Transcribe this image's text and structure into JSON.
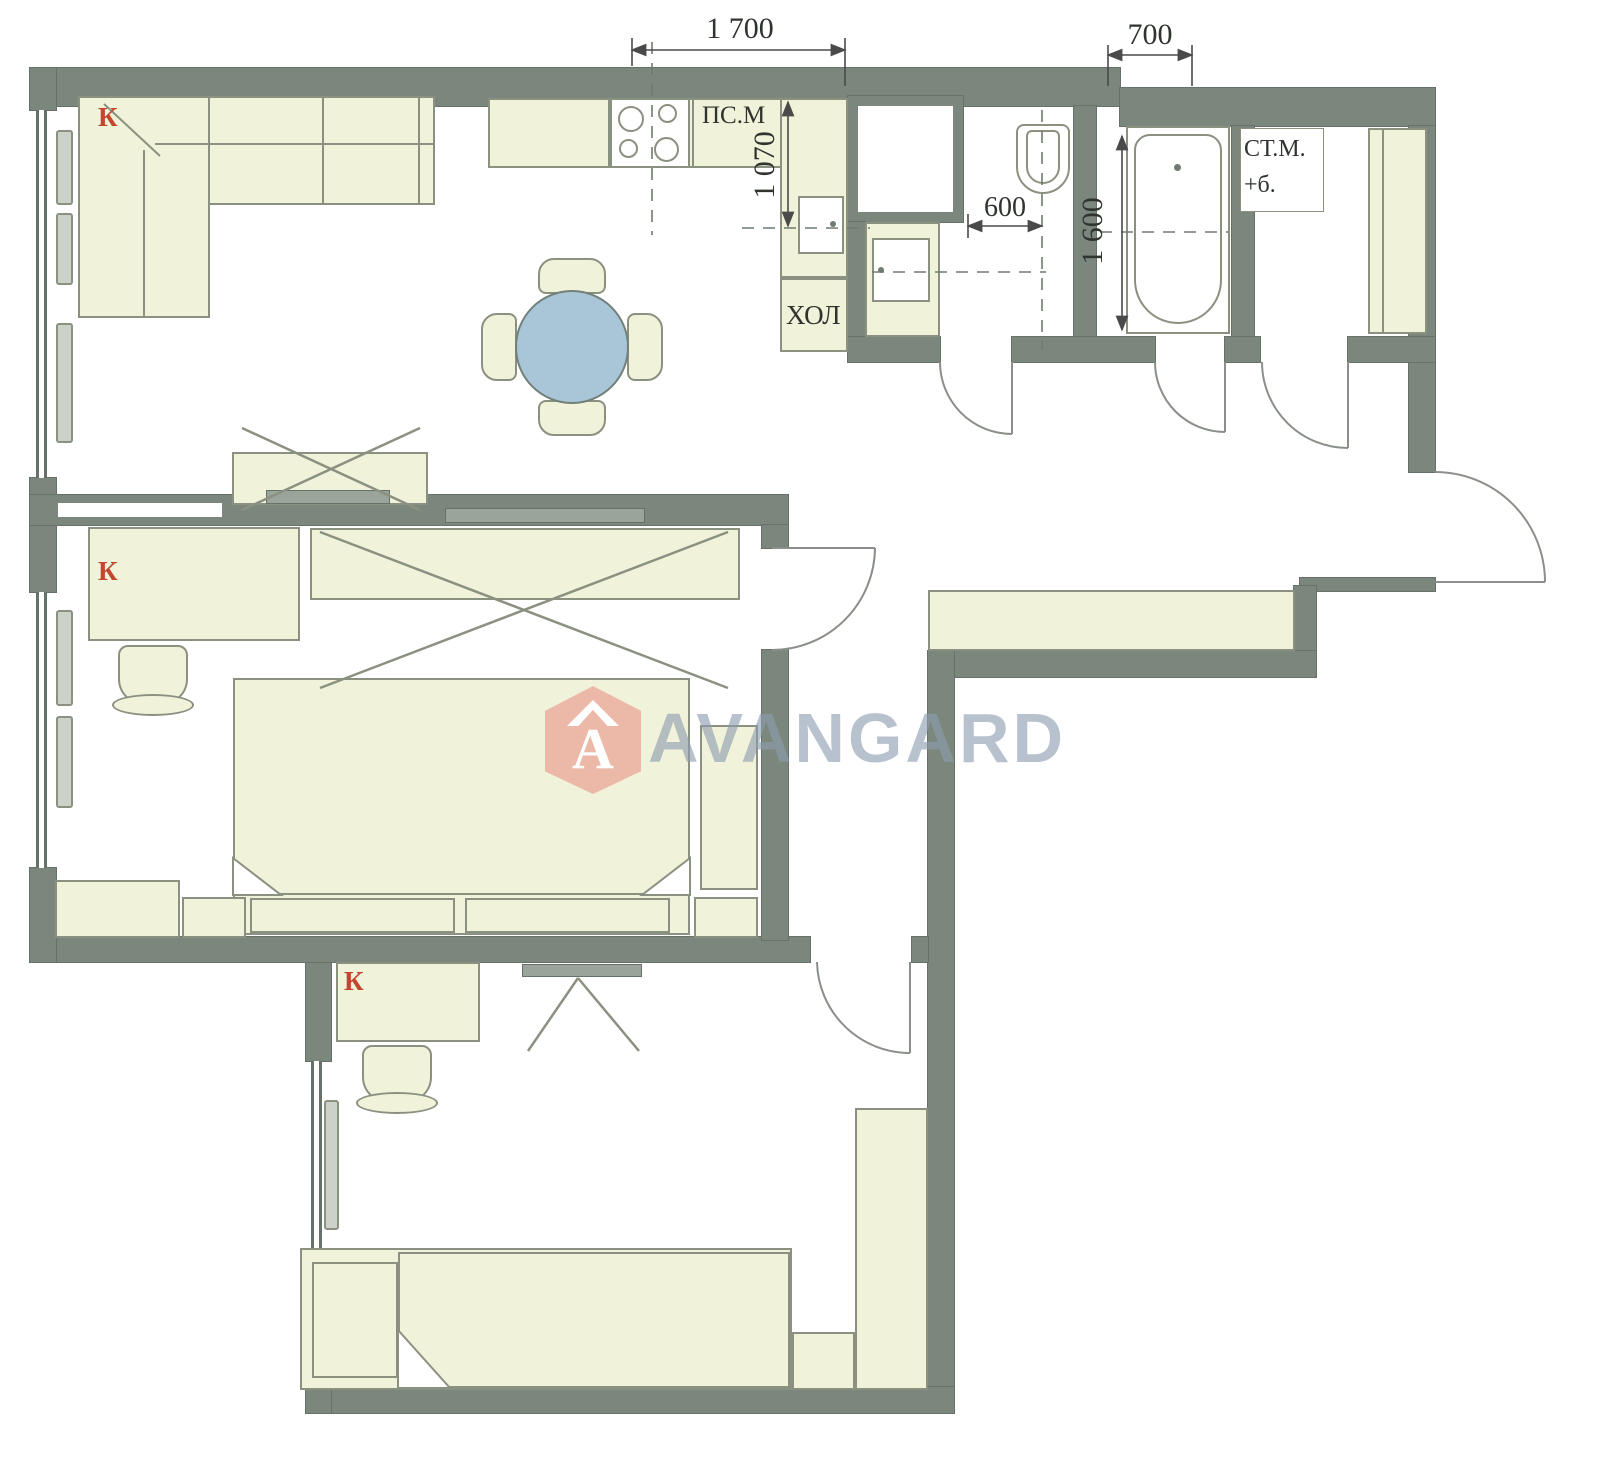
{
  "watermark": {
    "brand": "AVANGARD",
    "logo_letter": "A"
  },
  "dimensions": {
    "kitchen_top": "1 700",
    "top_right": "700",
    "kitchen_counter_depth": "1 070",
    "toilet_width": "600",
    "bath_length": "1 600"
  },
  "labels": {
    "dishwasher": "ПС.М",
    "fridge": "ХОЛ",
    "washer_line1": "СТ.М.",
    "washer_line2": "+б."
  },
  "room_marks": {
    "living": "К",
    "bedroom": "К",
    "kids": "К"
  },
  "colors": {
    "wall": "#7b867c",
    "furniture_fill": "#f1f2da",
    "furniture_border": "#8b9180",
    "table_blue": "#a9c6d8",
    "mark_red": "#c2462e",
    "watermark_pink": "#e78078",
    "watermark_gray": "#8c9cb0"
  }
}
